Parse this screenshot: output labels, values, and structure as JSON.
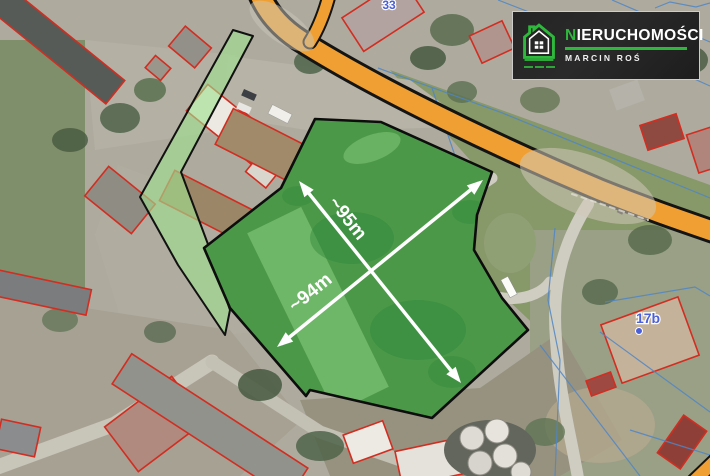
{
  "map": {
    "annotations": {
      "dim_diagonal": "~95m",
      "dim_cross": "~94m"
    },
    "labels": {
      "house_number_top": "33",
      "house_number_right": "17b"
    }
  },
  "logo": {
    "brand_initial": "N",
    "brand_rest": "IERUCHOMOŚCI",
    "person_name": "MARCIN ROŚ"
  },
  "colors": {
    "parcel-green": "#2fae46",
    "corridor-green": "#9fe08f",
    "road-orange": "#f0a032",
    "cadastral-red": "#d22d21",
    "cadastral-blue": "#4f86c6",
    "label-blue": "#4a5fd8",
    "arrow-white": "#ffffff",
    "logo-bg": "#1f1f1f",
    "logo-green": "#2eb83c"
  }
}
